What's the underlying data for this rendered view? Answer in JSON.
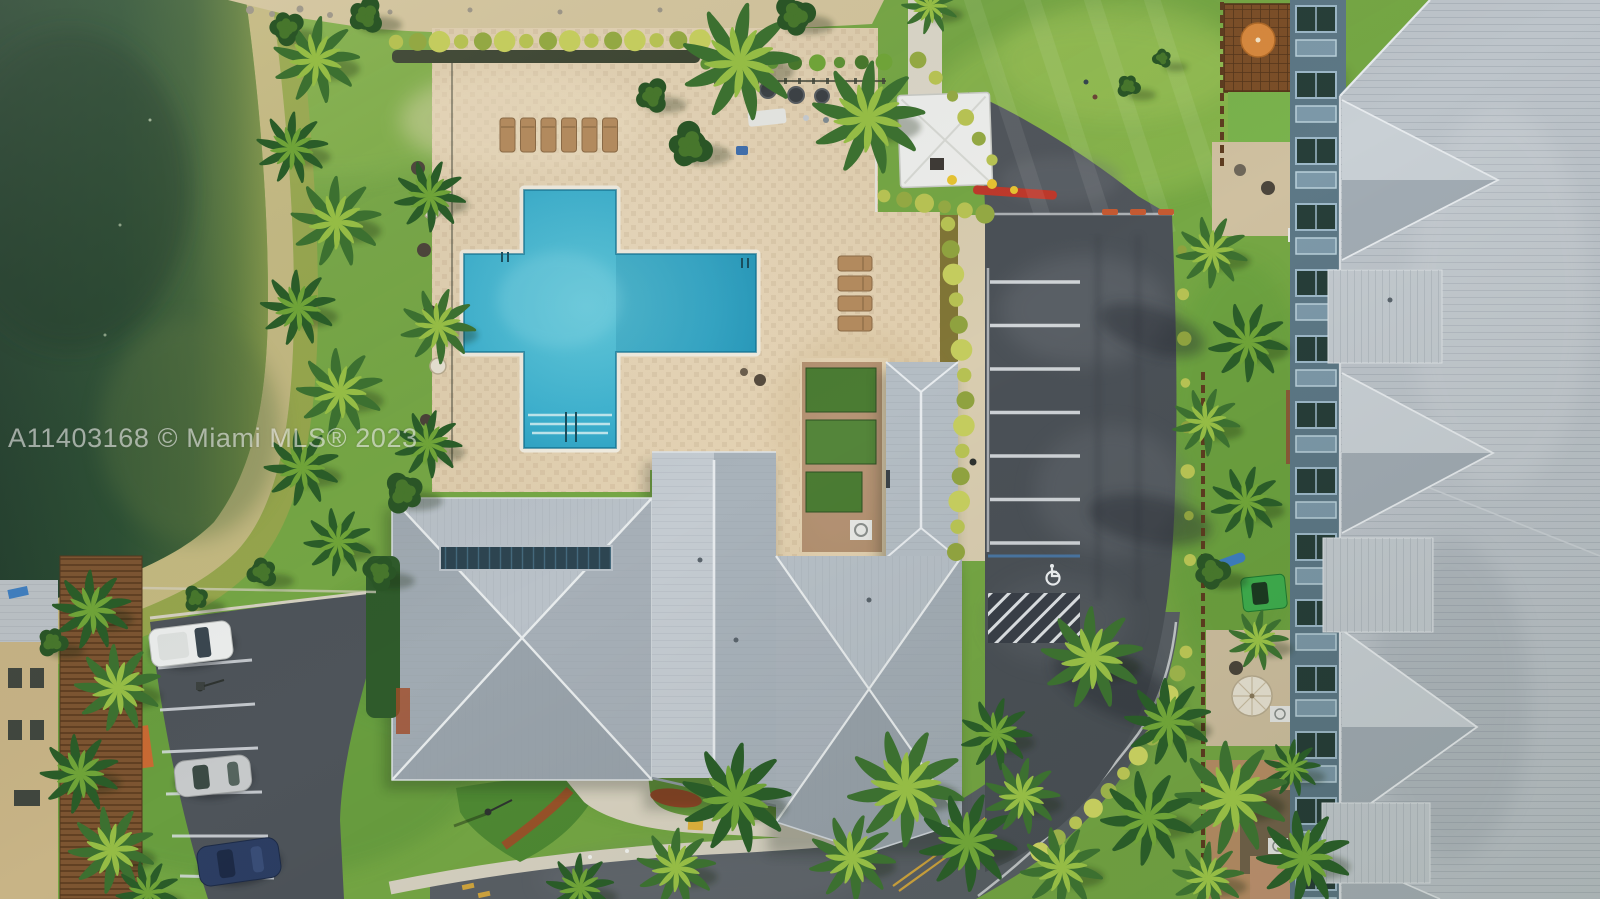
{
  "meta": {
    "title": "Aerial drone view of community pool, clubhouse, parking and condos"
  },
  "watermark": {
    "text": "A11403168 © Miami MLS® 2023"
  },
  "colors": {
    "grass": "#76a845",
    "grass_light": "#97c156",
    "grass_dark": "#4a8230",
    "lake_deep": "#223f2d",
    "shore_sand": "#c9bb85",
    "marsh": "#9ca74e",
    "pool_deck": "#e5d4b4",
    "pool_water": "#2ba4c5",
    "pool_water_light": "#60cadd",
    "pool_coping": "#f1ede1",
    "parking_asphalt": "#4b5157",
    "road_asphalt": "#5a6066",
    "driveway_asphalt": "#51565c",
    "paint_white": "#dde1e4",
    "paint_yellow": "#d2a63e",
    "paint_blue": "#4a7fb5",
    "roof_gray": "#aeb7be",
    "roof_light": "#c6cdd3",
    "roof_dark": "#9aa4ac",
    "ridge_white": "#e7ebee",
    "skylight_navy": "#2d4551",
    "condo_roof": "#bdc4ca",
    "condo_wall_frame": "#9db8c8",
    "condo_window": "#273e39",
    "hedge_dark": "#33582b",
    "shrub_yellow": "#b6c153",
    "mulch_red": "#a14c28",
    "fence_brown": "#6b4526",
    "pergola_brown": "#7c4f28",
    "patio_sand": "#cfc0a0",
    "concrete": "#d7d2c2",
    "canopy_white": "#eff0ee",
    "van_white": "#edefee",
    "car_silver": "#c6c9ca",
    "car_blue": "#2c3e63",
    "cart_green": "#3fae4e",
    "kayak_blue": "#3f7fc1",
    "umbrella_white": "#e9e3d3",
    "umbrella_orange": "#d8893e",
    "palm_dark": "#2a5c28",
    "palm_light": "#95bc45",
    "lounger_tan": "#b28a5e",
    "curb_orange": "#c65a32"
  },
  "scene": {
    "lake": {
      "type": "pond"
    },
    "pool": {
      "shape": "cross-with-lap-extension",
      "lounge_chairs_top": 6,
      "lounge_chairs_side": 4,
      "ladders": 2,
      "step_lines": 3
    },
    "amenities": {
      "grills": 3,
      "canopy": "white-event-tent",
      "playground": "red-yellow-equipment"
    },
    "parking": {
      "stripes": 7,
      "handicap_spaces": 1,
      "curb_stops": 3,
      "access_aisle": "hatched"
    },
    "small_lot": {
      "stripes": 6,
      "cars": [
        "white-van",
        "silver-car",
        "dark-blue-car"
      ]
    },
    "condos": {
      "dormers": 4,
      "lower_roofs": 3,
      "patio_umbrellas_white": 1,
      "patio_umbrellas_orange": 1
    },
    "road": {
      "marking": "double-yellow-centerline"
    }
  }
}
